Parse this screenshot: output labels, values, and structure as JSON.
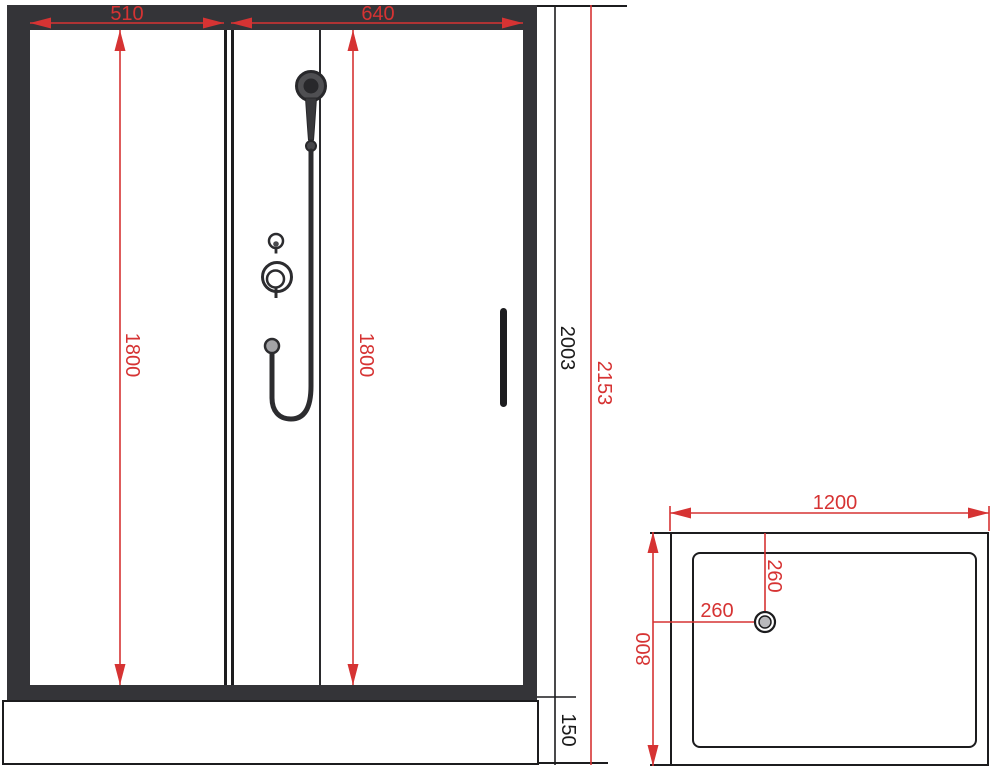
{
  "title": "shower cabin dimension drawing",
  "colors": {
    "dimension_red": "#d63333",
    "line_black": "#1c1c1e",
    "frame_dark": "#343438",
    "drain_gray": "#b9b9bc"
  },
  "front_view": {
    "top_width_left": "510",
    "top_width_right": "640",
    "panel_height_left": "1800",
    "panel_height_door": "1800",
    "cabin_height": "2003",
    "total_height": "2153",
    "tray_height": "150"
  },
  "top_view": {
    "tray_width": "1200",
    "tray_depth": "800",
    "drain_offset_from_top": "260",
    "drain_offset_from_left": "260"
  },
  "icons": {
    "shower_head": "hand-shower-icon",
    "mixer": "mixer-valve-icon",
    "diverter": "diverter-knob-icon",
    "drain": "drain-icon",
    "door_handle": "door-handle-icon"
  }
}
